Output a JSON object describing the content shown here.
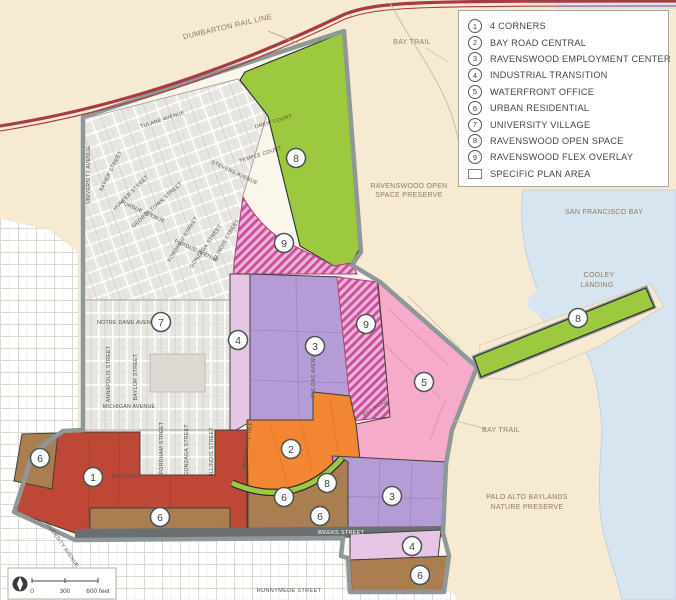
{
  "legend": {
    "items": [
      {
        "num": "1",
        "label": "4 CORNERS"
      },
      {
        "num": "2",
        "label": "BAY ROAD CENTRAL"
      },
      {
        "num": "3",
        "label": "RAVENSWOOD EMPLOYMENT CENTER"
      },
      {
        "num": "4",
        "label": "INDUSTRIAL TRANSITION"
      },
      {
        "num": "5",
        "label": "WATERFRONT OFFICE"
      },
      {
        "num": "6",
        "label": "URBAN RESIDENTIAL"
      },
      {
        "num": "7",
        "label": "UNIVERSITY VILLAGE"
      },
      {
        "num": "8",
        "label": "RAVENSWOOD OPEN SPACE"
      },
      {
        "num": "9",
        "label": "RAVENSWOOD FLEX OVERLAY"
      }
    ],
    "plan_area_label": "SPECIFIC PLAN AREA"
  },
  "map": {
    "label_styles": {
      "area": {
        "fill": "#8d7b64",
        "size": 7
      },
      "street": {
        "fill": "#55514a",
        "size": 5.2
      },
      "bar": {
        "fill": "#ffffff",
        "size": 5.5
      }
    },
    "labels": [
      {
        "t": "DUMBARTON RAIL LINE",
        "x": 228,
        "y": 29,
        "r": -13,
        "s": "area",
        "fs": 7.5
      },
      {
        "t": "BAY TRAIL",
        "x": 412,
        "y": 44,
        "s": "area"
      },
      {
        "t": "RAVENSWOOD OPEN",
        "x": 409,
        "y": 188,
        "s": "area"
      },
      {
        "t": "SPACE PRESERVE",
        "x": 409,
        "y": 197,
        "s": "area"
      },
      {
        "t": "SAN FRANCISCO BAY",
        "x": 604,
        "y": 214,
        "s": "area"
      },
      {
        "t": "COOLEY",
        "x": 599,
        "y": 277,
        "s": "area"
      },
      {
        "t": "LANDING",
        "x": 597,
        "y": 287,
        "s": "area"
      },
      {
        "t": "BAY TRAIL",
        "x": 501,
        "y": 432,
        "s": "area"
      },
      {
        "t": "PALO ALTO BAYLANDS",
        "x": 527,
        "y": 499,
        "s": "area"
      },
      {
        "t": "NATURE PRESERVE",
        "x": 527,
        "y": 509,
        "s": "area"
      },
      {
        "t": "RUNNYMEDE STREET",
        "x": 289,
        "y": 592,
        "s": "street",
        "fs": 5.6
      },
      {
        "t": "UNIVERSITY AVENUE",
        "x": 90,
        "y": 175,
        "r": -90,
        "s": "street"
      },
      {
        "t": "TULANE AVENUE",
        "x": 163,
        "y": 121,
        "r": -18,
        "s": "street"
      },
      {
        "t": "DREW COURT",
        "x": 274,
        "y": 123,
        "r": -17,
        "s": "street"
      },
      {
        "t": "TEMPLE COURT",
        "x": 261,
        "y": 156,
        "r": -18,
        "s": "street"
      },
      {
        "t": "STEVENS AVENUE",
        "x": 234,
        "y": 174,
        "r": 25,
        "s": "street"
      },
      {
        "t": "XAVIER STREET",
        "x": 112,
        "y": 172,
        "r": -63,
        "s": "street"
      },
      {
        "t": "HUNTER STREET",
        "x": 132,
        "y": 194,
        "r": -45,
        "s": "street"
      },
      {
        "t": "GEORGETOWN STREET",
        "x": 158,
        "y": 206,
        "r": -42,
        "s": "street"
      },
      {
        "t": "PURDUE AVENUE",
        "x": 142,
        "y": 213,
        "r": 24,
        "s": "street"
      },
      {
        "t": "FORDHAM STREET",
        "x": 184,
        "y": 240,
        "r": -58,
        "s": "street"
      },
      {
        "t": "GONZAGA STREET",
        "x": 207,
        "y": 247,
        "r": -55,
        "s": "street"
      },
      {
        "t": "ILLINOIS STREET",
        "x": 227,
        "y": 241,
        "r": -60,
        "s": "street"
      },
      {
        "t": "PURDUE AVENUE",
        "x": 196,
        "y": 252,
        "r": 24,
        "s": "street"
      },
      {
        "t": "NOTRE DAME AVENUE",
        "x": 128,
        "y": 324,
        "s": "street"
      },
      {
        "t": "ANNAPOLIS STREET",
        "x": 110,
        "y": 374,
        "r": -90,
        "s": "street"
      },
      {
        "t": "BAYLOR STREET",
        "x": 137,
        "y": 377,
        "r": -90,
        "s": "street"
      },
      {
        "t": "MICHIGAN AVENUE",
        "x": 129,
        "y": 408,
        "s": "street"
      },
      {
        "t": "FORDHAM STREET",
        "x": 163,
        "y": 448,
        "r": -90,
        "s": "street"
      },
      {
        "t": "GONZAGA STREET",
        "x": 188,
        "y": 450,
        "r": -90,
        "s": "street"
      },
      {
        "t": "ILLINOIS STREET",
        "x": 213,
        "y": 451,
        "r": -90,
        "s": "street"
      },
      {
        "t": "PULGAS AVENUE",
        "x": 315,
        "y": 374,
        "r": -90,
        "s": "street"
      },
      {
        "t": "DEMETER STREET",
        "x": 249,
        "y": 444,
        "r": -82,
        "s": "street"
      },
      {
        "t": "BAY ROAD",
        "x": 126,
        "y": 478,
        "s": "street"
      },
      {
        "t": "BAY ROAD",
        "x": 376,
        "y": 409,
        "r": -31,
        "s": "street"
      },
      {
        "t": "UNIVERSITY AVENUE",
        "x": 60,
        "y": 544,
        "r": 55,
        "s": "street"
      },
      {
        "t": "WEEKS STREET",
        "x": 341,
        "y": 534,
        "s": "bar"
      }
    ],
    "circles": [
      {
        "n": "8",
        "x": 296,
        "y": 158
      },
      {
        "n": "9",
        "x": 284,
        "y": 243
      },
      {
        "n": "7",
        "x": 161,
        "y": 322
      },
      {
        "n": "4",
        "x": 238,
        "y": 340
      },
      {
        "n": "3",
        "x": 315,
        "y": 346
      },
      {
        "n": "9",
        "x": 366,
        "y": 324
      },
      {
        "n": "5",
        "x": 424,
        "y": 382
      },
      {
        "n": "8",
        "x": 578,
        "y": 318
      },
      {
        "n": "1",
        "x": 93,
        "y": 477
      },
      {
        "n": "2",
        "x": 291,
        "y": 449
      },
      {
        "n": "6",
        "x": 40,
        "y": 458
      },
      {
        "n": "6",
        "x": 160,
        "y": 517
      },
      {
        "n": "6",
        "x": 284,
        "y": 497
      },
      {
        "n": "8",
        "x": 327,
        "y": 483
      },
      {
        "n": "6",
        "x": 320,
        "y": 516
      },
      {
        "n": "3",
        "x": 392,
        "y": 496
      },
      {
        "n": "4",
        "x": 412,
        "y": 546
      },
      {
        "n": "6",
        "x": 420,
        "y": 575
      }
    ],
    "scale": {
      "zero": "0",
      "mid": "300",
      "end": "600 feet"
    }
  },
  "colors": {
    "tan": "#f7ead3",
    "water": "#d7e5f0",
    "rail": "#a83b45",
    "boundary": "#8e9898",
    "green": "#9cc940",
    "hatch_base": "#eeb4d6",
    "hatch_stripe": "#c94f9e",
    "purple": "#b59cd6",
    "lavender": "#e6c6e4",
    "pink": "#f6abca",
    "orange": "#f28632",
    "red": "#bf4736",
    "brown": "#ab7e51"
  }
}
